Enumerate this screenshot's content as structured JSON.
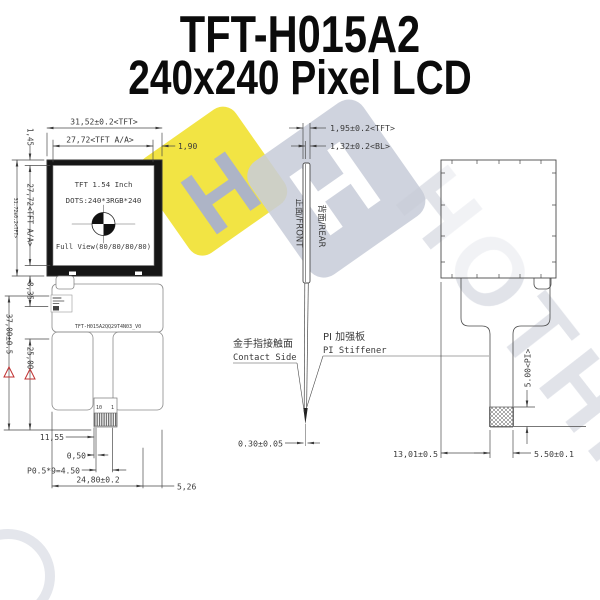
{
  "title": {
    "line1": "TFT-H015A2",
    "line2": "240x240 Pixel LCD"
  },
  "front_view": {
    "screen": {
      "line1": "TFT 1.54 Inch",
      "line2": "DOTS:240*3RGB*240",
      "line3": "Full View(80/80/80/80)"
    },
    "part_number": "TFT-H015A2QQ29T4N03_V0",
    "pins": {
      "first": "10",
      "last": "1"
    },
    "dims": {
      "width_tft": "31,52±0.2<TFT>",
      "width_aa": "27,72<TFT A/A>",
      "gap_right": "1,90",
      "top_margin": "1,45",
      "height_aa": "27,72<TFT A/A>",
      "height_tft": "31.72±0.2<TFT>",
      "below_panel": "8,35",
      "total_height": "37,00±0.5",
      "fpc_length": "25,00",
      "contact_offset": "11,55",
      "finger_offset": "0,50",
      "pitch": "P0.5*9=4.50",
      "contact_width": "24,80±0.2",
      "edge_gap": "5,26"
    }
  },
  "side_view": {
    "front_label": "正面/FRONT",
    "rear_label": "背面/REAR",
    "dims": {
      "thickness_tft": "1,95±0.2<TFT>",
      "thickness_bl": "1,32±0.2<BL>",
      "fpc_thickness": "0.30±0.05"
    },
    "contact_cn": "金手指接触面",
    "contact_en": "Contact Side",
    "stiffener_cn": "PI 加强板",
    "stiffener_en": "PI Stiffener"
  },
  "rear_view": {
    "dims": {
      "stiffener_height": "5.00<PI>",
      "tail_offset": "13,01±0.5",
      "stiffener_width": "5.50±0.1"
    }
  },
  "watermark": {
    "logo_letter": "H",
    "letters": "HOTHIN"
  },
  "colors": {
    "bezel": "#161616",
    "line": "#4a4a4a",
    "warning_red": "#c03030",
    "watermark_yellow": "#f2e33b",
    "watermark_gray": "#c6cbd7"
  }
}
